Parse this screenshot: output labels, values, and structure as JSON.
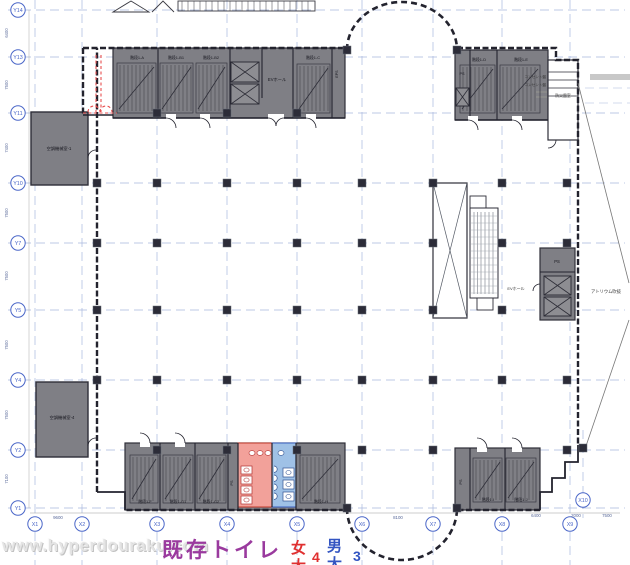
{
  "plan": {
    "watermark": "www.hyperdouraku.com",
    "caption": {
      "title": "既存トイレ",
      "female_label": "女",
      "female_sub": "大",
      "female_count": "4",
      "male_label": "男",
      "male_sub": "大",
      "male_count": "3"
    },
    "grid": {
      "x_labels": [
        "X1",
        "X2",
        "X3",
        "X4",
        "X5",
        "X6",
        "X7",
        "X8",
        "X9",
        "X10"
      ],
      "y_labels": [
        "Y14",
        "Y13",
        "Y11",
        "Y10",
        "Y7",
        "Y5",
        "Y4",
        "Y2",
        "Y1"
      ],
      "x_dims": [
        "9600",
        "8100",
        "6400",
        "2000",
        "7500"
      ],
      "y_dims": [
        "6400",
        "7500",
        "7400",
        "7500",
        "7500",
        "7500",
        "7500",
        "7100"
      ]
    },
    "rooms": {
      "machine_room_1": "空調機械室-1",
      "machine_room_4": "空調機械室-4",
      "ev_hall_top": "EVホール",
      "ev_hall_right": "EVホール",
      "atrium": "アトリウム吹抜",
      "disaster_room": "防災盤室",
      "outlet_panel_1": "コンセント盤",
      "outlet_panel_2": "コンセント盤",
      "ps": "PS",
      "eps": "EPS",
      "stairs": [
        "階段1-A",
        "階段1-B1",
        "階段1-B2",
        "階段1-C",
        "階段1-D",
        "階段1-E",
        "階段1-F",
        "階段1-G1",
        "階段1-G2",
        "階段1-H",
        "階段1-I",
        "階段1-J"
      ]
    },
    "colors": {
      "grid_blue": "#a8b8de",
      "bubble_blue": "#4a66c8",
      "wall": "#23232e",
      "room_gray": "#7f7f85",
      "women_pink": "#f2a19a",
      "men_blue": "#9fc1e6",
      "red_dashed": "#e84f4f",
      "caption_purple": "#9a3a9e",
      "caption_red": "#e03030",
      "caption_blue": "#3355c2"
    }
  }
}
